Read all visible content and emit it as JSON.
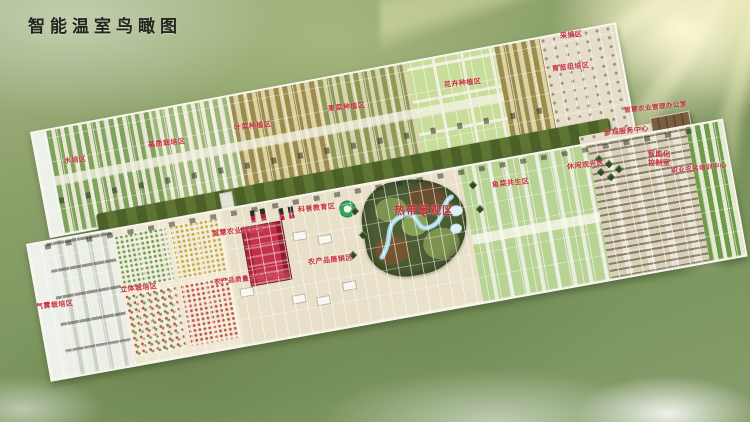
{
  "page_title": "智能温室鸟瞰图",
  "colors": {
    "label_red": "#c5303c",
    "title_color": "#23271d",
    "grass_green": "#7f9760",
    "sun_glow": "#fff7be"
  },
  "labels": {
    "hydroponics": "水培区",
    "substrate": "基质栽培区",
    "leafy": "叶菜种植区",
    "fruit_veg": "果菜种植区",
    "flowers": "花卉种植区",
    "picking": "采摘区",
    "nursery": "育苗组培区",
    "office": "智慧农业管理办公室",
    "visitor_center": "参观服务中心",
    "leisure": "休闲观光区",
    "control_room": "智能化\n控制室",
    "training_center": "职业农民培训中心",
    "aeroponics": "气雾栽培区",
    "vertical": "立体栽培区",
    "experience": "智慧农业体验区",
    "science": "科普教育区",
    "product_expo": "农产品展销区",
    "quality_center": "农产品质量安全检测中心",
    "tropical": "热带景观区",
    "aquaponics": "鱼菜共生区"
  }
}
